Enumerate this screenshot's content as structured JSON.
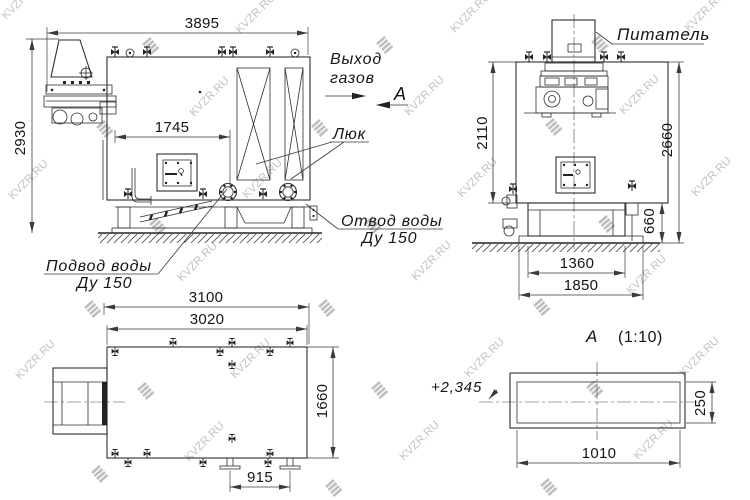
{
  "watermark": {
    "text": "KVZR.RU"
  },
  "colors": {
    "line": "#2e2e2e",
    "text": "#151515",
    "watermark": "#b3b3b3",
    "background": "#ffffff"
  },
  "side_view": {
    "dim_width": "3895",
    "dim_height": "2930",
    "dim_door_offset": "1745",
    "label_gas_out_line1": "Выход",
    "label_gas_out_line2": "газов",
    "section_mark": "А",
    "label_hatch": "Люк",
    "label_water_out_line1": "Отвод воды",
    "label_water_out_line2": "Ду 150",
    "label_water_in_line1": "Подвод воды",
    "label_water_in_line2": "Ду 150"
  },
  "front_view": {
    "label_feeder": "Питатель",
    "dim_height_upper": "2110",
    "dim_height_total": "2660",
    "dim_height_base": "660",
    "dim_width_base": "1360",
    "dim_width_frame": "1850"
  },
  "plan_view": {
    "dim_width_overall": "3100",
    "dim_width_body": "3020",
    "dim_depth": "1660",
    "dim_pipe_spacing": "915"
  },
  "section_view": {
    "mark": "А",
    "scale": "(1:10)",
    "elevation": "+2,345",
    "dim_width": "1010",
    "dim_height": "250"
  }
}
